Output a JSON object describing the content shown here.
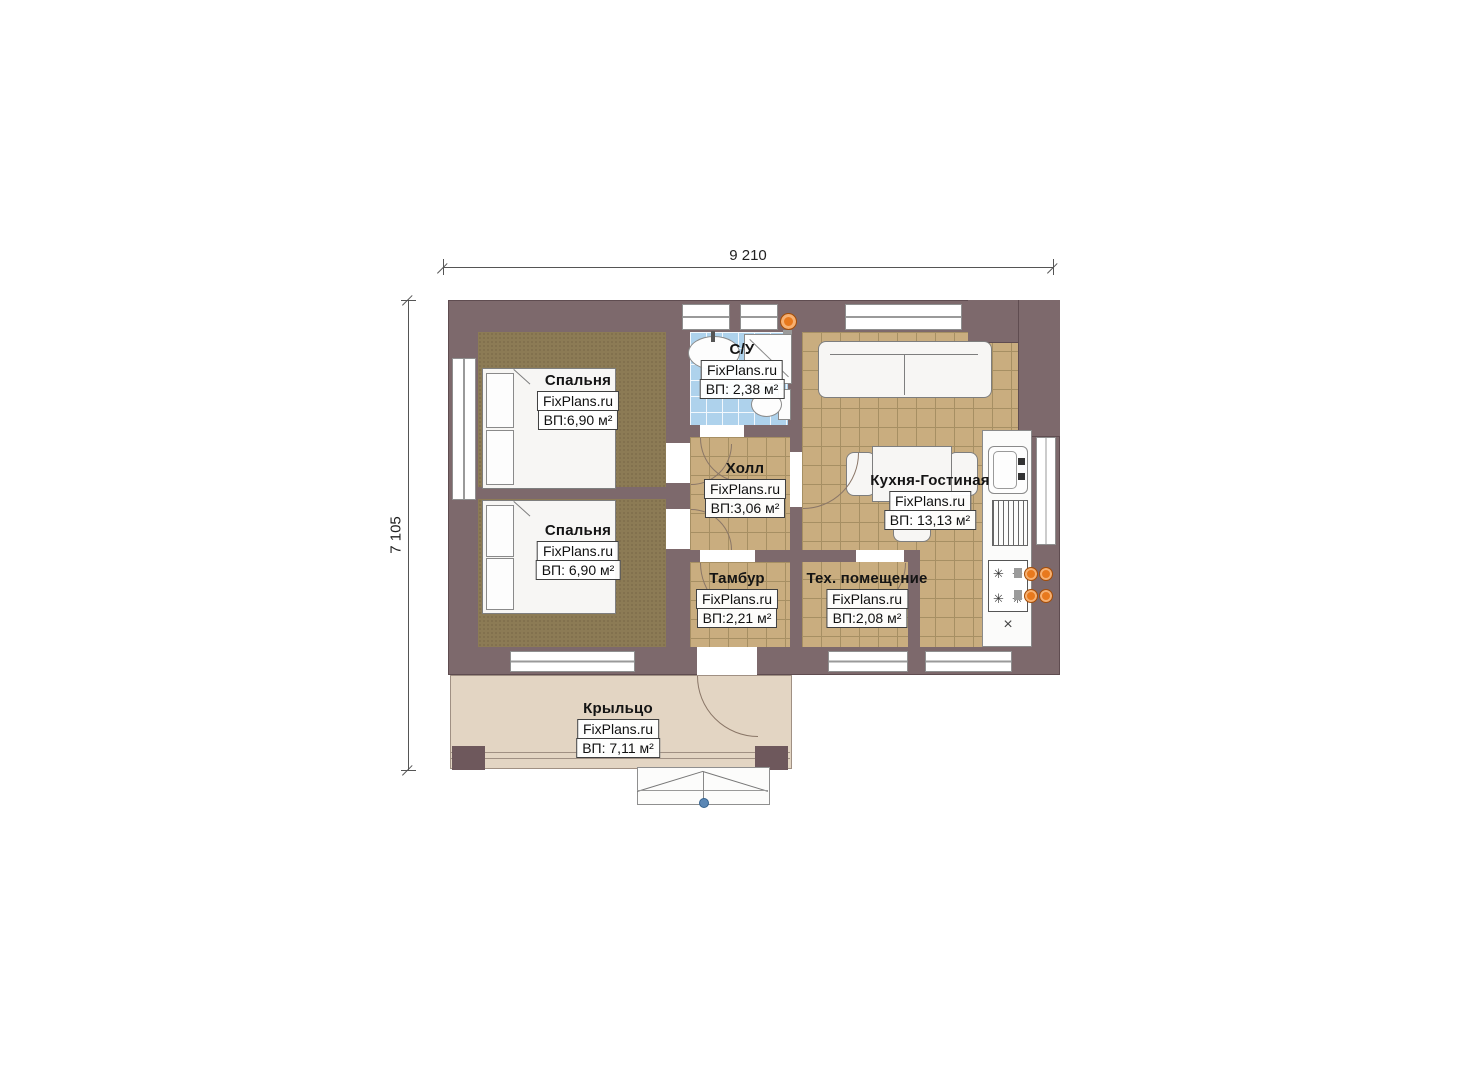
{
  "watermark": "FixPlans.ru",
  "dimensions": {
    "width_mm": "9 210",
    "height_mm": "7 105"
  },
  "rooms": [
    {
      "id": "bedroom-1",
      "name": "Спальня",
      "area": "ВП:6,90 м²"
    },
    {
      "id": "bedroom-2",
      "name": "Спальня",
      "area": "ВП: 6,90 м²"
    },
    {
      "id": "bathroom",
      "name": "С/У",
      "area": "ВП: 2,38 м²"
    },
    {
      "id": "hall",
      "name": "Холл",
      "area": "ВП:3,06 м²"
    },
    {
      "id": "kitchen-living",
      "name": "Кухня-Гостиная",
      "area": "ВП: 13,13 м²"
    },
    {
      "id": "vestibule",
      "name": "Тамбур",
      "area": "ВП:2,21 м²"
    },
    {
      "id": "tech-room",
      "name": "Тех. помещение",
      "area": "ВП:2,08 м²"
    },
    {
      "id": "porch",
      "name": "Крыльцо",
      "area": "ВП: 7,11 м²"
    }
  ],
  "icons": {
    "burner": "✳",
    "cross": "×"
  },
  "colors": {
    "wall": "#7d696c",
    "carpet": "#8c7b55",
    "tile": "#c9ad7f",
    "bath_tile": "#aed2ec",
    "porch": "#e3d5c3",
    "accent_orange": "#e8791d",
    "marker_blue": "#5b87b5"
  }
}
